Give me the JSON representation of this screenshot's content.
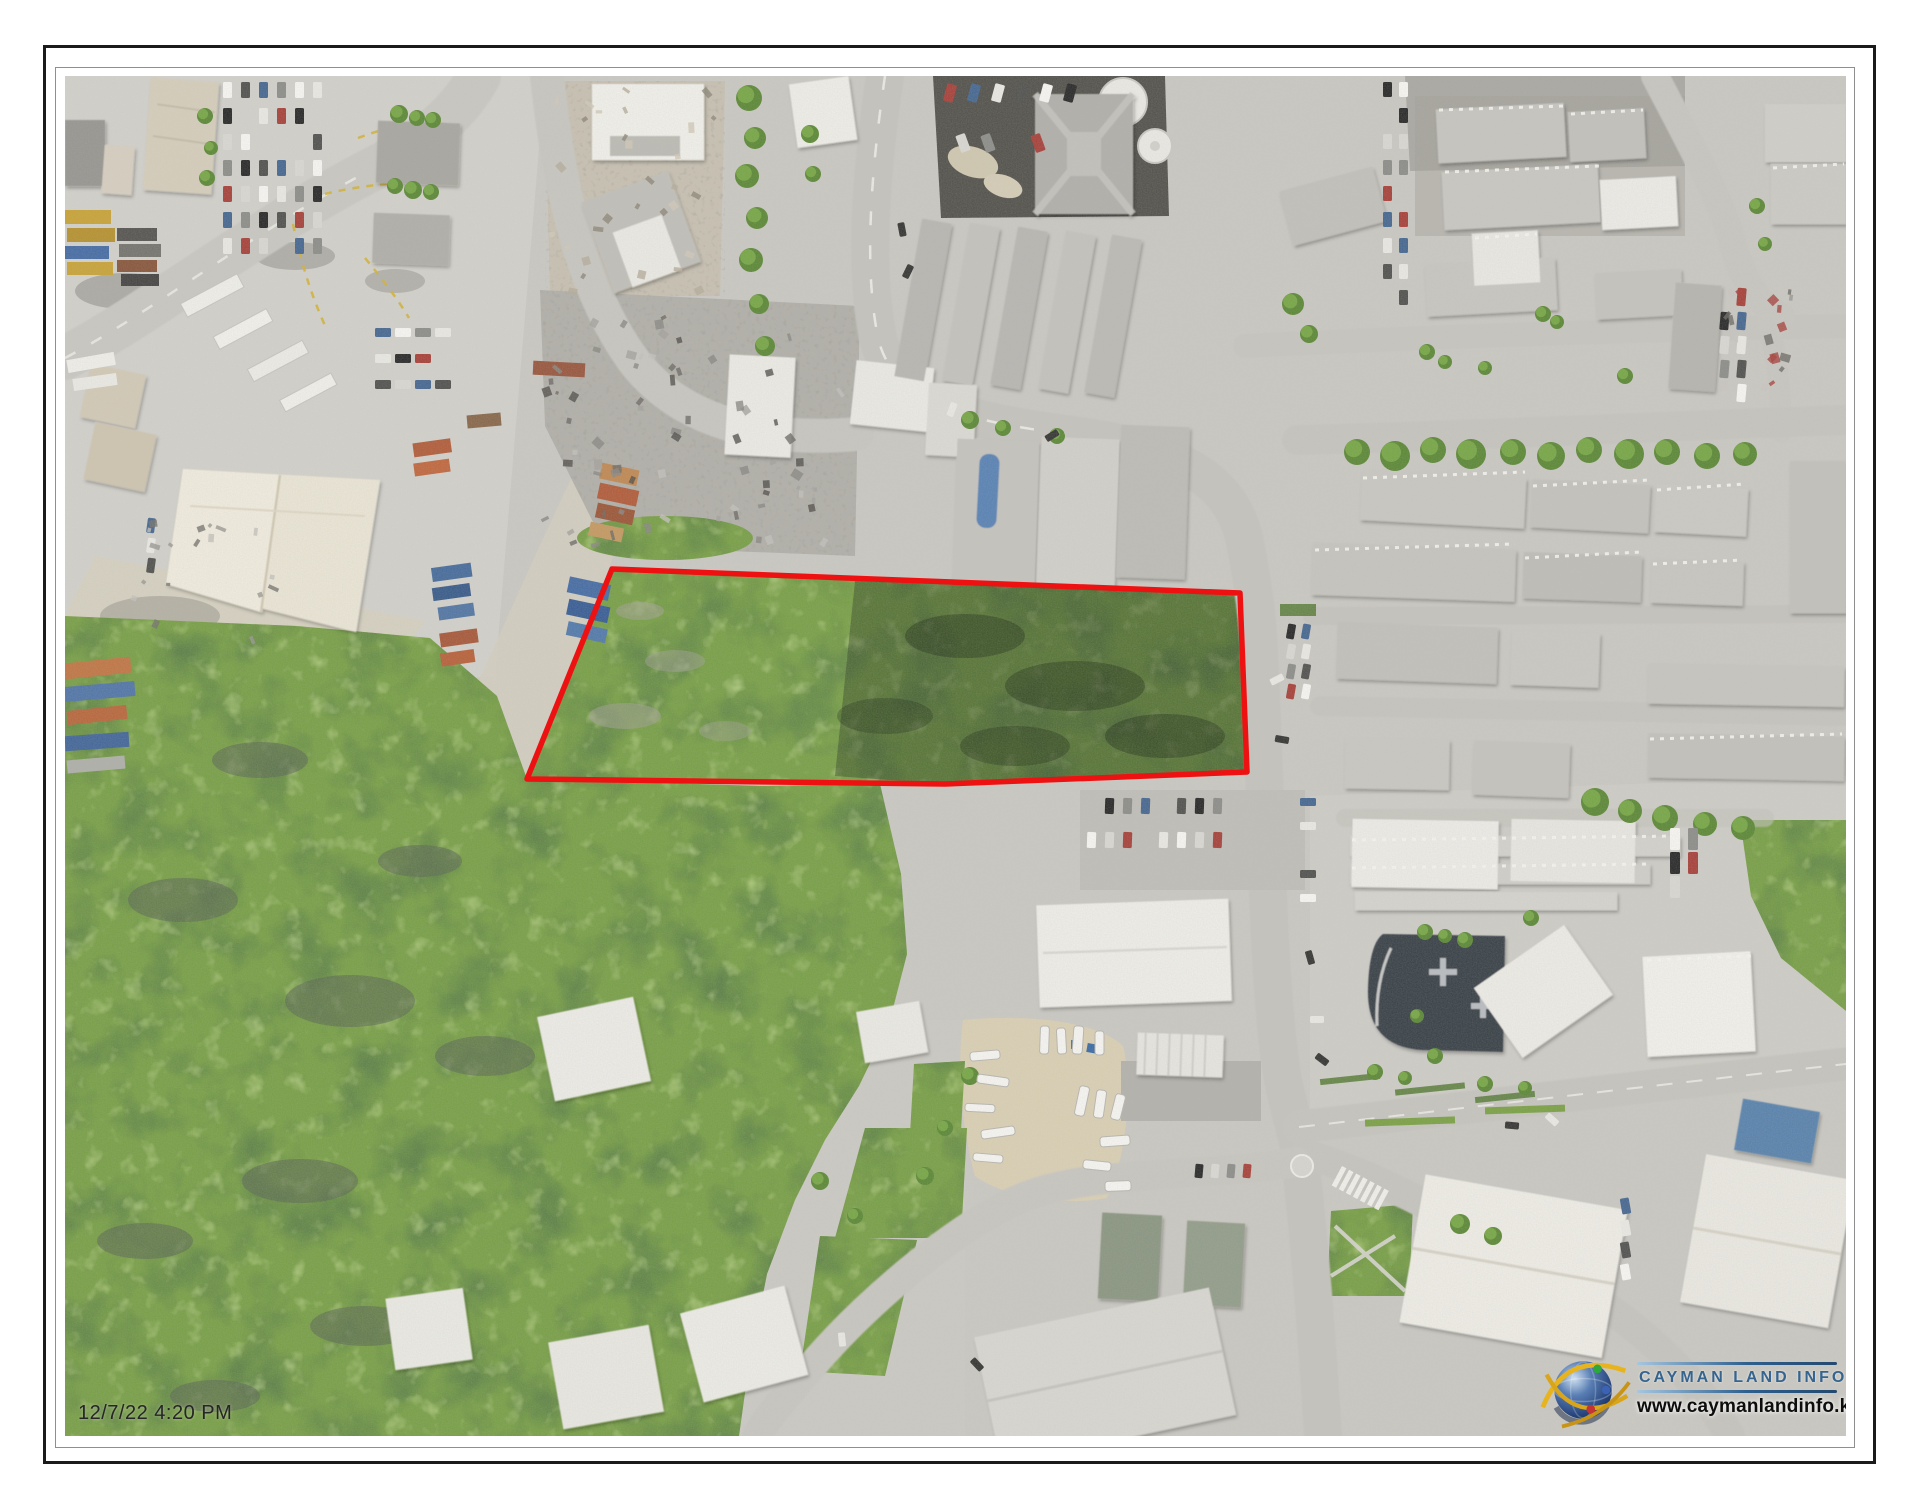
{
  "title_block": {
    "timestamp": "12/7/22 4:20 PM"
  },
  "logo": {
    "title": "CAYMAN LAND INFO",
    "url": "www.caymanlandinfo.ky"
  },
  "colors": {
    "parcel_outline_red": "#ee1111",
    "logo_title_blue": "#35648f",
    "logo_rule_blue": "#2e5f8e",
    "logo_url_black": "#0d0d0d",
    "timestamp_text": "#262626",
    "vegetation_green": "#7aa04a"
  },
  "map_annotations": {
    "parcel_outline_points_px": "547,493 1175,517 1182,696 880,708 462,703"
  }
}
